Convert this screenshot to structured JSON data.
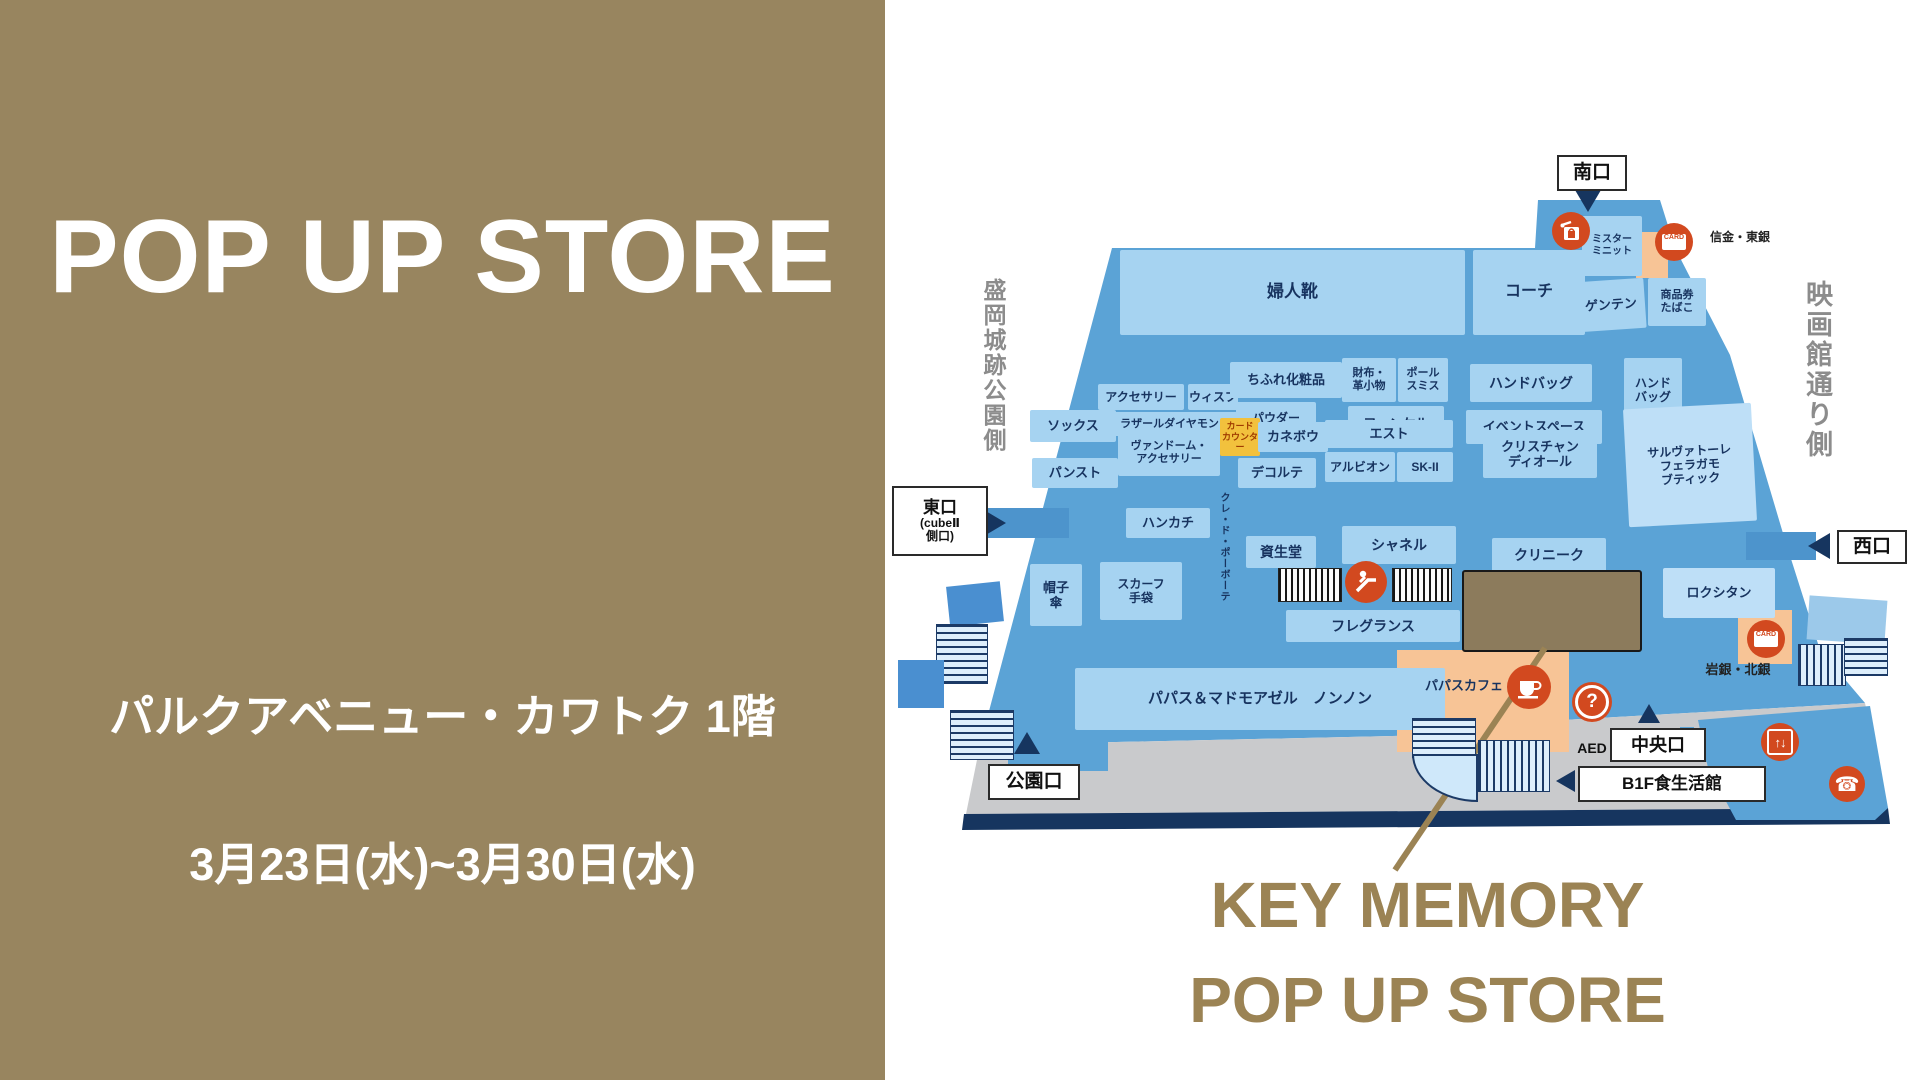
{
  "left_panel": {
    "title": "POP UP STORE",
    "location": "パルクアベニュー・カワトク 1階",
    "dates": "3月23日(水)~3月30日(水)"
  },
  "callout": {
    "line1": "KEY MEMORY",
    "line2": "POP UP STORE"
  },
  "map": {
    "gates": {
      "south": "南口",
      "west": "西口",
      "park": "公園口",
      "central": "中央口",
      "b1f": "B1F食生活館",
      "east1": "東口",
      "east2": "(cubeⅡ",
      "east3": "側口)"
    },
    "streets": {
      "left": "盛岡城跡公園側",
      "right": "映画館通り側"
    },
    "labels": {
      "bank1": "信金・東銀",
      "bank2": "岩銀・北銀",
      "aed": "AED",
      "card_counter": "カード\nカウンター",
      "card_icon": "CARD",
      "elevator_glyph": "↑↓",
      "question_glyph": "?",
      "phone_glyph": "☎"
    },
    "stores": {
      "fujinkutsu": "婦人靴",
      "coach": "コーチ",
      "mister_minit": "ミスター\nミニット",
      "genten": "ゲンテン",
      "shohinken": "商品券\nたばこ",
      "accessory": "アクセサリー",
      "wisp": "ウィスプ",
      "lazare": "ラザールダイヤモンド",
      "chifure": "ちふれ化粧品",
      "powder": "パウダー\nパレット",
      "wallet": "財布・\n革小物",
      "paul_smith": "ポール\nスミス",
      "fancl": "ファンケル",
      "handbag": "ハンドバッグ",
      "event_space": "イベントスペース",
      "handbag2": "ハンド\nバッグ",
      "socks": "ソックス",
      "panst": "パンスト",
      "vendome": "ヴァンドーム・\nアクセサリー",
      "kanebo": "カネボウ",
      "decorte": "デコルテ",
      "est": "エスト",
      "albion": "アルビオン",
      "sk2": "SK-II",
      "dior": "クリスチャン\nディオール",
      "ferragamo": "サルヴァトーレ\nフェラガモ\nブティック",
      "handkerchief": "ハンカチ",
      "cledepeau": "クレ・ド・ポーボーテ",
      "shiseido": "資生堂",
      "chanel": "シャネル",
      "clinique": "クリニーク",
      "hat": "帽子\n傘",
      "scarf": "スカーフ\n手袋",
      "fragrance": "フレグランス",
      "loccitane": "ロクシタン",
      "papas": "パパス＆マドモアゼル　ノンノン",
      "papas_cafe": "パパスカフェ"
    },
    "colors": {
      "panel_olive": "#98855f",
      "callout_gold": "#9b8354",
      "floor_blue": "#5ba3d6",
      "walk_blue": "#4d94cc",
      "block_blue": "#a6d3f1",
      "block_light": "#bedff7",
      "orange": "#f7c496",
      "icon_red": "#d2491f",
      "navy": "#16355f",
      "yellow": "#f2c13d",
      "sidewalk_gray": "#c9cacc",
      "highlight_brown": "#8c7b5c"
    }
  }
}
